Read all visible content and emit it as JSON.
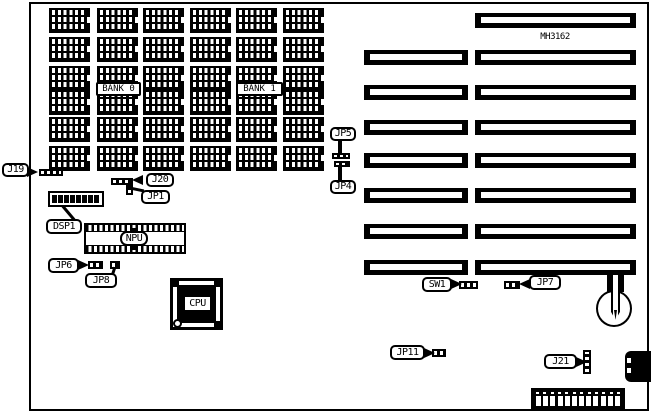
{
  "diagram": {
    "part_number": "MH3162",
    "memory": {
      "bank0_label": "BANK 0",
      "bank1_label": "BANK 1",
      "chip_rows": 6,
      "chip_columns": 6
    },
    "slots": {
      "short_count": 7,
      "long_count": 8
    },
    "labels": {
      "j19": "J19",
      "j20": "J20",
      "jp1": "JP1",
      "dsp1": "DSP1",
      "npu": "NPU",
      "jp6": "JP6",
      "jp8": "JP8",
      "cpu": "CPU",
      "jp5": "JP5",
      "jp4": "JP4",
      "sw1": "SW1",
      "jp7": "JP7",
      "jp11": "JP11",
      "j21": "J21"
    },
    "dsp1_display": {
      "segments": 8
    },
    "power_connector": {
      "pins": 12
    },
    "colors": {
      "ink": "#000000",
      "background": "#ffffff"
    }
  }
}
